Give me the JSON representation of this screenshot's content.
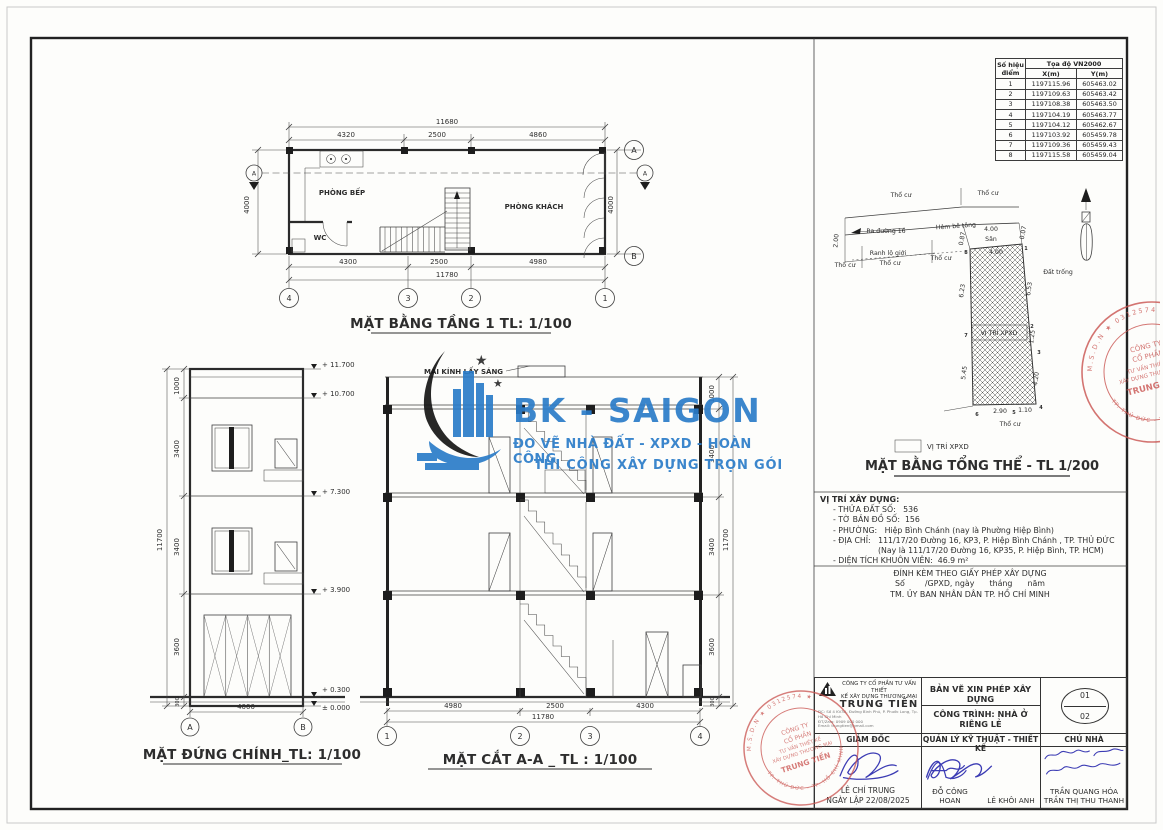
{
  "colors": {
    "logo_blue": "#2b7cc9",
    "stamp_red": "#c9534f",
    "ink_blue": "#3c3cb4"
  },
  "floor_plan": {
    "title": "MẶT BẰNG TẦNG 1 TL: 1/100",
    "dim_total_top": "11680",
    "dims_top": [
      "4320",
      "2500",
      "4860"
    ],
    "dims_bottom": [
      "4300",
      "2500",
      "4980"
    ],
    "dim_total_bottom": "11780",
    "dim_left": "4000",
    "dim_right": "4000",
    "rooms": {
      "kitchen": "PHÒNG BẾP",
      "wc": "WC",
      "living": "PHÒNG KHÁCH"
    },
    "grid_cols": [
      "4",
      "3",
      "2",
      "1"
    ],
    "grid_a": "A",
    "grid_b": "B",
    "section_mark": "A"
  },
  "elevation": {
    "title": "MẶT ĐỨNG CHÍNH_TL: 1/100",
    "levels": [
      "+ 11.700",
      "+ 10.700",
      "+ 7.300",
      "+ 3.900",
      "+ 0.300",
      "± 0.000"
    ],
    "dims_left": [
      "1000",
      "3400",
      "3400",
      "3600",
      "300"
    ],
    "dim_total": "11700",
    "dim_bottom": "4000",
    "grid_a": "A",
    "grid_b": "B"
  },
  "section_view": {
    "title": "MẶT CẮT A-A _ TL : 1/100",
    "roof_label": "MÁI KÍNH LẤY SÁNG",
    "dims_right": [
      "1000",
      "3400",
      "3400",
      "3600",
      "300"
    ],
    "dim_total": "11700",
    "dims_bottom": [
      "4980",
      "2500",
      "4300"
    ],
    "dim_total_bottom": "11780",
    "grid": [
      "1",
      "2",
      "3",
      "4"
    ]
  },
  "logo": {
    "name": "BK - SAIGON",
    "tagline1": "ĐO VẼ NHÀ ĐẤT - XPXD - HOÀN CÔNG",
    "tagline2": "THI CÔNG XÂY DỰNG TRỌN GÓI"
  },
  "coord_table": {
    "col_point_line1": "Số hiệu",
    "col_point_line2": "điểm",
    "col_group": "Tọa độ VN2000",
    "col_x": "X(m)",
    "col_y": "Y(m)",
    "rows": [
      {
        "n": "1",
        "x": "1197115.96",
        "y": "605463.02"
      },
      {
        "n": "2",
        "x": "1197109.63",
        "y": "605463.42"
      },
      {
        "n": "3",
        "x": "1197108.38",
        "y": "605463.50"
      },
      {
        "n": "4",
        "x": "1197104.19",
        "y": "605463.77"
      },
      {
        "n": "5",
        "x": "1197104.12",
        "y": "605462.67"
      },
      {
        "n": "6",
        "x": "1197103.92",
        "y": "605459.78"
      },
      {
        "n": "7",
        "x": "1197109.36",
        "y": "605459.43"
      },
      {
        "n": "8",
        "x": "1197115.58",
        "y": "605459.04"
      }
    ]
  },
  "site_plan": {
    "title": "MẶT BẰNG TỔNG THỂ - TL 1/200",
    "legend_label": "VỊ TRÍ XPXD",
    "plot_label": "VỊ TRÍ XPXD",
    "labels": {
      "tho_cu": "Thổ cư",
      "ra_duong": "Ra đường 16",
      "hem_be_tong": "Hẻm bê tông",
      "ranh_lo_gioi": "Ranh lộ giới",
      "san": "Sân",
      "dat_trong": "Đất trống"
    },
    "dims": {
      "d200": "2.00",
      "d087": "0.87",
      "d007": "0.07",
      "d400_road": "4.00",
      "d400_san": "4.00",
      "d623": "6.23",
      "d545": "5.45",
      "d653": "6.53",
      "d125": "1.25",
      "d420": "4.20",
      "d290": "2.90",
      "d110": "1.10"
    },
    "points": [
      "1",
      "2",
      "3",
      "4",
      "5",
      "6",
      "7",
      "8"
    ]
  },
  "location": {
    "heading": "VỊ TRÍ XÂY DỰNG:",
    "items": [
      "- THỬA ĐẤT SỐ:   536",
      "- TỜ BẢN ĐỒ SỐ:  156",
      "- PHƯỜNG:   Hiệp Bình Chánh (nay là Phường Hiệp Bình)",
      "- ĐỊA CHỈ:   111/17/20 Đường 16, KP3, P. Hiệp Bình Chánh , TP. THỦ ĐỨC",
      "(Nay là 111/17/20 Đường 16, KP35, P. Hiệp Bình, TP. HCM)",
      "- DIỆN TÍCH KHUÔN VIÊN:  46.9 m²"
    ]
  },
  "permit": {
    "line1": "ĐÍNH KÈM THEO GIẤY PHÉP XÂY DỰNG",
    "line2": "Số        /GPXD, ngày      tháng      năm",
    "line3": "TM. ỦY BAN NHÂN DÂN TP. HỒ CHÍ MINH"
  },
  "title_block": {
    "company_line1": "CÔNG TY CỔ PHẦN TƯ VẤN THIẾT",
    "company_line2": "KẾ XÂY DỰNG THƯƠNG MẠI",
    "company_name": "TRUNG TIẾN",
    "company_addr1": "ĐC: Số 4 KV3A, Đường Bình Phú, P. Phước Long, Tp. Hồ Chí Minh",
    "company_addr2": "ĐT/Zalo: 0909 000 000",
    "company_addr3": "Email: trungtien@gmail.com",
    "doc_type": "BẢN VẼ XIN PHÉP XÂY DỰNG",
    "project": "CÔNG TRÌNH: NHÀ Ở RIÊNG LẺ",
    "sheet_no": "01",
    "sheet_total": "02",
    "role1": "GIÁM ĐỐC",
    "role2": "QUẢN LÝ KỸ THUẬT - THIẾT KẾ",
    "role3": "CHỦ NHÀ",
    "director": "LÊ CHÍ TRUNG",
    "date": "NGÀY LẬP 22/08/2025",
    "designer": "ĐỖ CÔNG HOAN",
    "checker": "LÊ KHÔI ANH",
    "owner1": "TRẦN QUANG HÓA",
    "owner2": "TRẦN THỊ THU THANH"
  },
  "seal": {
    "line1": "CÔNG TY",
    "line2": "CỔ PHẦN",
    "line3": "TƯ VẤN THIẾT KẾ",
    "line4": "XÂY DỰNG THƯƠNG MẠI",
    "name": "TRUNG TIẾN",
    "rim_top": "M.S.D.N ★ 0312574 ★",
    "rim_bottom": "TP. THỦ ĐỨC - TP. HỒ CHÍ MINH"
  }
}
